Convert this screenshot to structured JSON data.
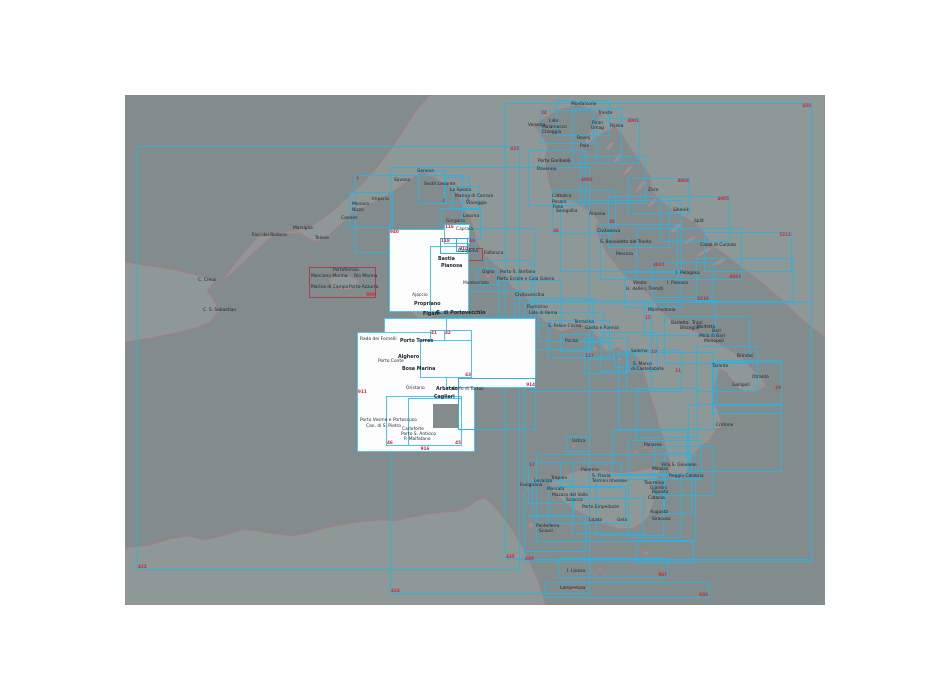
{
  "map": {
    "x": 125,
    "y": 95,
    "w": 700,
    "h": 510,
    "sea_color": "#828c8d",
    "land_color": "#8e9997",
    "coast_color": "#b5787c",
    "box_color": "#35aed8",
    "box_white_border": "#4cc4ee",
    "red_box_color": "#a94348",
    "number_color": "#cc2a33",
    "label_color": "#16242e",
    "white_fill": "#fdfdfd"
  },
  "boxes": [
    [
      137,
      146,
      383,
      424,
      "c",
      "432@tr|432@bl"
    ],
    [
      390,
      167,
      200,
      427,
      "c",
      "434@bl"
    ],
    [
      505,
      103,
      307,
      457,
      "c",
      "435@tr|435@bl"
    ],
    [
      524,
      302,
      288,
      260,
      "c",
      "439@bl"
    ],
    [
      558,
      558,
      110,
      20,
      "c",
      "947@br"
    ],
    [
      545,
      582,
      164,
      16,
      "c",
      "936@br"
    ],
    [
      355,
      175,
      108,
      78,
      "c",
      "1@tl"
    ],
    [
      349,
      192,
      44,
      36,
      "c",
      ""
    ],
    [
      418,
      170,
      28,
      34,
      "c",
      "2@br"
    ],
    [
      444,
      177,
      26,
      26,
      "c",
      "3@br"
    ],
    [
      452,
      186,
      28,
      24,
      "c",
      ""
    ],
    [
      441,
      208,
      40,
      32,
      "c",
      ""
    ],
    [
      443,
      228,
      92,
      90,
      "c",
      ""
    ],
    [
      468,
      260,
      64,
      32,
      "c",
      ""
    ],
    [
      476,
      268,
      22,
      17,
      "c",
      ""
    ],
    [
      498,
      280,
      64,
      46,
      "c",
      ""
    ],
    [
      514,
      298,
      80,
      52,
      "c",
      ""
    ],
    [
      538,
      312,
      66,
      30,
      "c",
      ""
    ],
    [
      548,
      320,
      62,
      38,
      "c",
      ""
    ],
    [
      584,
      338,
      44,
      36,
      "c",
      "127@ml"
    ],
    [
      600,
      332,
      58,
      40,
      "c",
      "10@mr"
    ],
    [
      626,
      350,
      56,
      42,
      "c",
      "11@mr"
    ],
    [
      618,
      352,
      96,
      78,
      "c",
      ""
    ],
    [
      636,
      388,
      62,
      50,
      "c",
      ""
    ],
    [
      612,
      430,
      76,
      46,
      "c",
      ""
    ],
    [
      628,
      440,
      74,
      40,
      "c",
      ""
    ],
    [
      654,
      446,
      60,
      50,
      "c",
      ""
    ],
    [
      664,
      452,
      28,
      62,
      "c",
      ""
    ],
    [
      536,
      454,
      160,
      88,
      "c",
      ""
    ],
    [
      560,
      462,
      62,
      26,
      "c",
      ""
    ],
    [
      566,
      436,
      24,
      16,
      "c",
      ""
    ],
    [
      528,
      462,
      46,
      42,
      "c",
      "17@tl"
    ],
    [
      532,
      480,
      42,
      36,
      "c",
      ""
    ],
    [
      548,
      486,
      78,
      38,
      "c",
      ""
    ],
    [
      572,
      498,
      72,
      36,
      "c",
      ""
    ],
    [
      596,
      474,
      68,
      62,
      "c",
      ""
    ],
    [
      628,
      474,
      54,
      64,
      "c",
      ""
    ],
    [
      524,
      516,
      62,
      36,
      "c",
      ""
    ],
    [
      636,
      540,
      58,
      24,
      "c",
      ""
    ],
    [
      688,
      404,
      94,
      68,
      "c",
      ""
    ],
    [
      712,
      362,
      70,
      52,
      "c",
      "28@mr"
    ],
    [
      696,
      346,
      62,
      46,
      "c",
      ""
    ],
    [
      716,
      360,
      66,
      46,
      "c",
      ""
    ],
    [
      664,
      316,
      86,
      48,
      "c",
      ""
    ],
    [
      644,
      300,
      72,
      36,
      "c",
      "12@ml"
    ],
    [
      624,
      272,
      58,
      36,
      "c",
      ""
    ],
    [
      652,
      262,
      62,
      36,
      "c",
      "4017@tl"
    ],
    [
      636,
      228,
      106,
      52,
      "c",
      "4043@br"
    ],
    [
      660,
      196,
      70,
      46,
      "c",
      "4005@tr"
    ],
    [
      628,
      178,
      62,
      36,
      "c",
      "4004@tr"
    ],
    [
      696,
      258,
      98,
      44,
      "c",
      "5210@bl"
    ],
    [
      704,
      232,
      88,
      40,
      "c",
      "5212@tr"
    ],
    [
      540,
      110,
      54,
      34,
      "c",
      "34@tl"
    ],
    [
      556,
      100,
      54,
      36,
      "c",
      ""
    ],
    [
      572,
      108,
      50,
      56,
      "c",
      ""
    ],
    [
      596,
      118,
      44,
      46,
      "c",
      "4001@tr"
    ],
    [
      580,
      156,
      66,
      48,
      "c",
      "4002@ml"
    ],
    [
      528,
      150,
      58,
      56,
      "c",
      ""
    ],
    [
      552,
      190,
      64,
      44,
      "c",
      "36@bl"
    ],
    [
      608,
      196,
      62,
      52,
      "c",
      "35@ml"
    ],
    [
      560,
      200,
      122,
      72,
      "c",
      ""
    ],
    [
      600,
      224,
      78,
      56,
      "c",
      ""
    ],
    [
      530,
      300,
      122,
      92,
      "c",
      ""
    ],
    [
      560,
      334,
      30,
      18,
      "c",
      ""
    ],
    [
      588,
      342,
      26,
      18,
      "c",
      ""
    ],
    [
      614,
      354,
      22,
      14,
      "c",
      ""
    ],
    [
      455,
      248,
      28,
      13,
      "r",
      ""
    ],
    [
      309,
      267,
      67,
      31,
      "r",
      "909@br"
    ],
    [
      389,
      229,
      80,
      83,
      "w",
      "940@tl"
    ],
    [
      430,
      246,
      39,
      66,
      "w",
      "910@tr"
    ],
    [
      444,
      224,
      26,
      20,
      "w",
      "116@tl"
    ],
    [
      384,
      318,
      82,
      134,
      "w",
      "916@bc"
    ],
    [
      357,
      332,
      118,
      120,
      "w",
      "911@ml"
    ],
    [
      446,
      318,
      90,
      70,
      "w",
      "914@br"
    ],
    [
      386,
      396,
      76,
      50,
      "w",
      "46@bl"
    ],
    [
      408,
      398,
      54,
      48,
      "w",
      "45@br"
    ],
    [
      430,
      330,
      28,
      22,
      "w",
      "41@tl"
    ],
    [
      444,
      330,
      28,
      22,
      "w",
      "42@tl"
    ],
    [
      420,
      340,
      52,
      38,
      "w",
      "43@br"
    ],
    [
      433,
      404,
      25,
      24,
      "g",
      ""
    ],
    [
      458,
      378,
      78,
      52,
      "c",
      ""
    ],
    [
      440,
      238,
      28,
      16,
      "c",
      "118@tl"
    ],
    [
      456,
      238,
      20,
      14,
      "c",
      "40@tr"
    ]
  ],
  "labels": [
    {
      "t": "Foci del Rodano",
      "x": 252,
      "y": 236
    },
    {
      "t": "Marsiglia",
      "x": 293,
      "y": 229
    },
    {
      "t": "Tolone",
      "x": 315,
      "y": 239
    },
    {
      "t": "Cannes",
      "x": 341,
      "y": 219
    },
    {
      "t": "Nizza",
      "x": 352,
      "y": 211
    },
    {
      "t": "Monaco",
      "x": 352,
      "y": 205
    },
    {
      "t": "Imperia",
      "x": 372,
      "y": 200
    },
    {
      "t": "Savona",
      "x": 394,
      "y": 181
    },
    {
      "t": "Genova",
      "x": 417,
      "y": 172
    },
    {
      "t": "Sestri Levante",
      "x": 424,
      "y": 185
    },
    {
      "t": "La Spezia",
      "x": 450,
      "y": 191
    },
    {
      "t": "Marina di Carrara",
      "x": 455,
      "y": 197
    },
    {
      "t": "Viareggio",
      "x": 466,
      "y": 204
    },
    {
      "t": "Livorno",
      "x": 463,
      "y": 217
    },
    {
      "t": "Gorgona",
      "x": 446,
      "y": 222
    },
    {
      "t": "Capraia",
      "x": 456,
      "y": 230
    },
    {
      "t": "C. Creus",
      "x": 198,
      "y": 281
    },
    {
      "t": "C. S. Sebastian",
      "x": 203,
      "y": 311
    },
    {
      "t": "Portoferraio",
      "x": 333,
      "y": 271
    },
    {
      "t": "Marciana Marina",
      "x": 311,
      "y": 277
    },
    {
      "t": "Rio Marina",
      "x": 354,
      "y": 277
    },
    {
      "t": "Marina di Campo",
      "x": 311,
      "y": 288
    },
    {
      "t": "Porto Azzurro",
      "x": 349,
      "y": 288
    },
    {
      "t": "Piombino",
      "x": 458,
      "y": 252
    },
    {
      "t": "Follonica",
      "x": 484,
      "y": 254
    },
    {
      "t": "Giglio",
      "x": 482,
      "y": 273
    },
    {
      "t": "Montecristo",
      "x": 463,
      "y": 284
    },
    {
      "t": "Porto S. Stefano",
      "x": 500,
      "y": 273
    },
    {
      "t": "Porto Ercole e Cala Galera",
      "x": 497,
      "y": 280
    },
    {
      "t": "Civitavecchia",
      "x": 515,
      "y": 296
    },
    {
      "t": "Fiumicino",
      "x": 527,
      "y": 308
    },
    {
      "t": "Lido di Roma",
      "x": 529,
      "y": 314
    },
    {
      "t": "S. Felice Circeo",
      "x": 548,
      "y": 327
    },
    {
      "t": "Terracina",
      "x": 574,
      "y": 323
    },
    {
      "t": "Gaeta e Formia",
      "x": 585,
      "y": 329
    },
    {
      "t": "Ponza",
      "x": 565,
      "y": 342
    },
    {
      "t": "Salerno",
      "x": 631,
      "y": 352
    },
    {
      "t": "S. Marco",
      "x": 633,
      "y": 365
    },
    {
      "t": "di Castellabate",
      "x": 631,
      "y": 370
    },
    {
      "t": "Monfalcone",
      "x": 571,
      "y": 105
    },
    {
      "t": "Trieste",
      "x": 598,
      "y": 114
    },
    {
      "t": "Venezia",
      "x": 528,
      "y": 126
    },
    {
      "t": "Lido",
      "x": 549,
      "y": 122
    },
    {
      "t": "Malamocco",
      "x": 542,
      "y": 128
    },
    {
      "t": "Chioggia",
      "x": 542,
      "y": 133
    },
    {
      "t": "Porto Garibaldi",
      "x": 538,
      "y": 162
    },
    {
      "t": "Ravenna",
      "x": 537,
      "y": 170
    },
    {
      "t": "Cattolica",
      "x": 552,
      "y": 197
    },
    {
      "t": "Pesaro",
      "x": 552,
      "y": 203
    },
    {
      "t": "Fano",
      "x": 553,
      "y": 208
    },
    {
      "t": "Senigallia",
      "x": 556,
      "y": 212
    },
    {
      "t": "Ancona",
      "x": 589,
      "y": 215
    },
    {
      "t": "Civitanova",
      "x": 597,
      "y": 232
    },
    {
      "t": "S. Benedetto del Tronto",
      "x": 600,
      "y": 243
    },
    {
      "t": "Pescara",
      "x": 616,
      "y": 255
    },
    {
      "t": "Piran",
      "x": 592,
      "y": 124
    },
    {
      "t": "Umag",
      "x": 591,
      "y": 129
    },
    {
      "t": "Rovinj",
      "x": 577,
      "y": 139
    },
    {
      "t": "Pola",
      "x": 580,
      "y": 147
    },
    {
      "t": "Rijeka",
      "x": 610,
      "y": 127
    },
    {
      "t": "Zara",
      "x": 648,
      "y": 191
    },
    {
      "t": "Sibenik",
      "x": 673,
      "y": 211
    },
    {
      "t": "Split",
      "x": 694,
      "y": 222
    },
    {
      "t": "Canal di Curzola",
      "x": 700,
      "y": 246
    },
    {
      "t": "I. Pelagosa",
      "x": 676,
      "y": 274
    },
    {
      "t": "I. Pianosa",
      "x": 667,
      "y": 284
    },
    {
      "t": "Vieste",
      "x": 633,
      "y": 284
    },
    {
      "t": "Is. delle I. Tremiti",
      "x": 626,
      "y": 290
    },
    {
      "t": "Manfredonia",
      "x": 648,
      "y": 311
    },
    {
      "t": "Barletta",
      "x": 671,
      "y": 324
    },
    {
      "t": "Trani",
      "x": 692,
      "y": 324
    },
    {
      "t": "Bisceglie",
      "x": 680,
      "y": 329
    },
    {
      "t": "Molfetta",
      "x": 697,
      "y": 328
    },
    {
      "t": "Bari",
      "x": 712,
      "y": 332
    },
    {
      "t": "Mola di Bari",
      "x": 699,
      "y": 337
    },
    {
      "t": "Monopoli",
      "x": 704,
      "y": 342
    },
    {
      "t": "Brindisi",
      "x": 737,
      "y": 357
    },
    {
      "t": "Taranto",
      "x": 712,
      "y": 367
    },
    {
      "t": "Gallipoli",
      "x": 732,
      "y": 386
    },
    {
      "t": "Otranto",
      "x": 752,
      "y": 378
    },
    {
      "t": "Crotone",
      "x": 716,
      "y": 426
    },
    {
      "t": "Ustica",
      "x": 572,
      "y": 442
    },
    {
      "t": "Palermo",
      "x": 581,
      "y": 471
    },
    {
      "t": "S. Flavia",
      "x": 592,
      "y": 477
    },
    {
      "t": "Termini Imerese",
      "x": 592,
      "y": 482
    },
    {
      "t": "Trapani",
      "x": 551,
      "y": 479
    },
    {
      "t": "Favignana",
      "x": 520,
      "y": 486
    },
    {
      "t": "Levanzo",
      "x": 534,
      "y": 482
    },
    {
      "t": "Marsala",
      "x": 547,
      "y": 490
    },
    {
      "t": "Mazara del Vallo",
      "x": 552,
      "y": 496
    },
    {
      "t": "Sciacca",
      "x": 566,
      "y": 501
    },
    {
      "t": "Porto Empedocle",
      "x": 582,
      "y": 508
    },
    {
      "t": "Licata",
      "x": 589,
      "y": 521
    },
    {
      "t": "Gela",
      "x": 617,
      "y": 521
    },
    {
      "t": "Panarea",
      "x": 644,
      "y": 446
    },
    {
      "t": "Milazzo",
      "x": 652,
      "y": 470
    },
    {
      "t": "Villa S. Giovanni",
      "x": 661,
      "y": 466
    },
    {
      "t": "Reggio Calabria",
      "x": 669,
      "y": 477
    },
    {
      "t": "Taormina",
      "x": 644,
      "y": 484
    },
    {
      "t": "Giardini",
      "x": 650,
      "y": 489
    },
    {
      "t": "Riposto",
      "x": 652,
      "y": 493
    },
    {
      "t": "Catania",
      "x": 648,
      "y": 499
    },
    {
      "t": "Augusta",
      "x": 650,
      "y": 513
    },
    {
      "t": "Siracusa",
      "x": 652,
      "y": 520
    },
    {
      "t": "Pantelleria",
      "x": 536,
      "y": 527
    },
    {
      "t": "Scauri",
      "x": 539,
      "y": 532
    },
    {
      "t": "I. Linosa",
      "x": 567,
      "y": 572
    },
    {
      "t": "Lampedusa",
      "x": 560,
      "y": 589
    },
    {
      "t": "Bastia",
      "x": 438,
      "y": 260,
      "b": 1
    },
    {
      "t": "Pianosa",
      "x": 441,
      "y": 267,
      "b": 1
    },
    {
      "t": "Ajaccio",
      "x": 412,
      "y": 296
    },
    {
      "t": "Propriano",
      "x": 414,
      "y": 305,
      "b": 1
    },
    {
      "t": "Figari",
      "x": 423,
      "y": 315,
      "b": 1
    },
    {
      "t": "G. di Portovecchio",
      "x": 436,
      "y": 314,
      "b": 1
    },
    {
      "t": "Rada dei Fornelli",
      "x": 360,
      "y": 340
    },
    {
      "t": "Porto Torres",
      "x": 400,
      "y": 342,
      "b": 1
    },
    {
      "t": "Alghero",
      "x": 398,
      "y": 358,
      "b": 1
    },
    {
      "t": "Porto Conte",
      "x": 378,
      "y": 362
    },
    {
      "t": "Bosa Marina",
      "x": 402,
      "y": 370,
      "b": 1
    },
    {
      "t": "Oristano",
      "x": 406,
      "y": 389
    },
    {
      "t": "Arbatax",
      "x": 436,
      "y": 390,
      "b": 1
    },
    {
      "t": "Golfo di Tortoli",
      "x": 452,
      "y": 390
    },
    {
      "t": "Cagliari",
      "x": 434,
      "y": 398,
      "b": 1
    },
    {
      "t": "Porto Vesme e Portoscuso",
      "x": 360,
      "y": 421
    },
    {
      "t": "Can. di S. Pietro",
      "x": 366,
      "y": 427
    },
    {
      "t": "Carloforte",
      "x": 402,
      "y": 430
    },
    {
      "t": "Porto S. Antioco",
      "x": 401,
      "y": 435
    },
    {
      "t": "P. Malfatano",
      "x": 404,
      "y": 440
    }
  ]
}
